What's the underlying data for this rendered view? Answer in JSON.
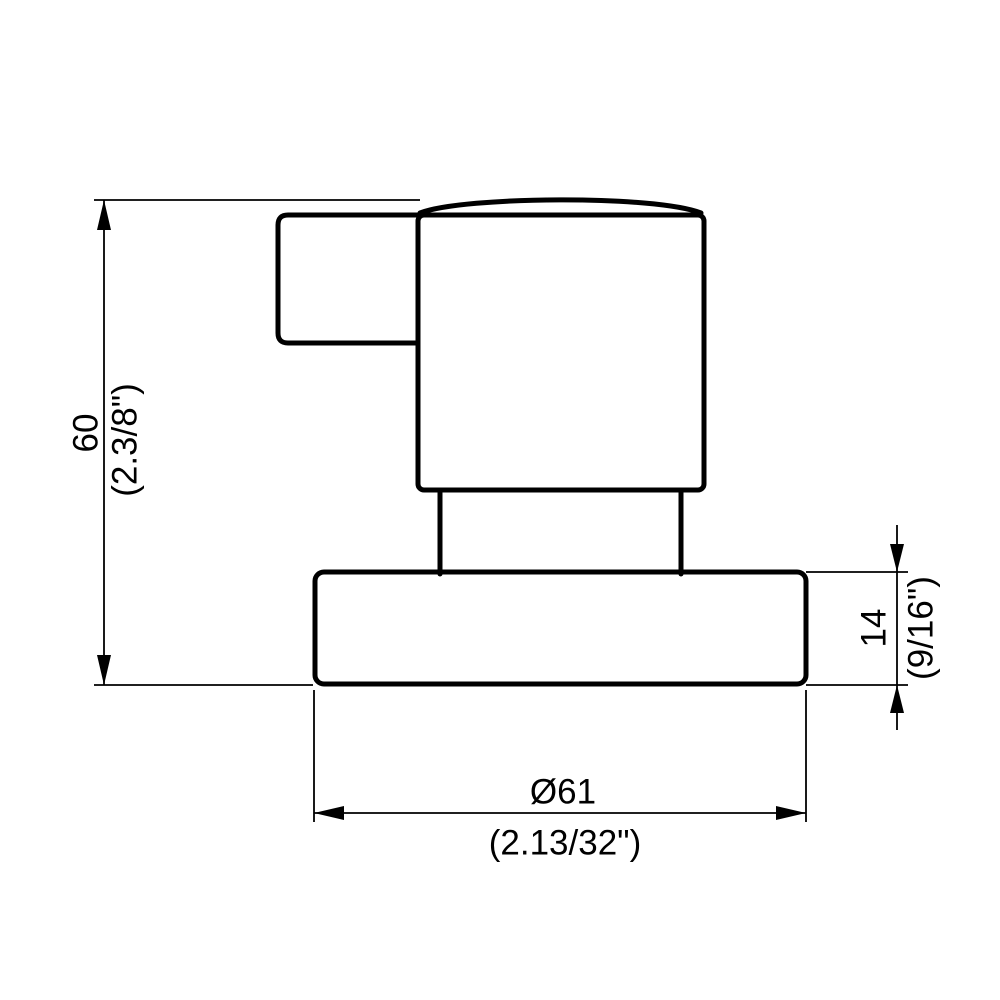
{
  "drawing": {
    "kind": "technical-dimension-drawing",
    "colors": {
      "line": "#000000",
      "background": "#ffffff"
    },
    "dimensions": {
      "height": {
        "metric": "60",
        "imperial": "(2.3/8\")"
      },
      "base_thickness": {
        "metric": "14",
        "imperial": "(9/16\")"
      },
      "base_diameter": {
        "metric": "Ø61",
        "imperial": "(2.13/32\")"
      }
    }
  }
}
